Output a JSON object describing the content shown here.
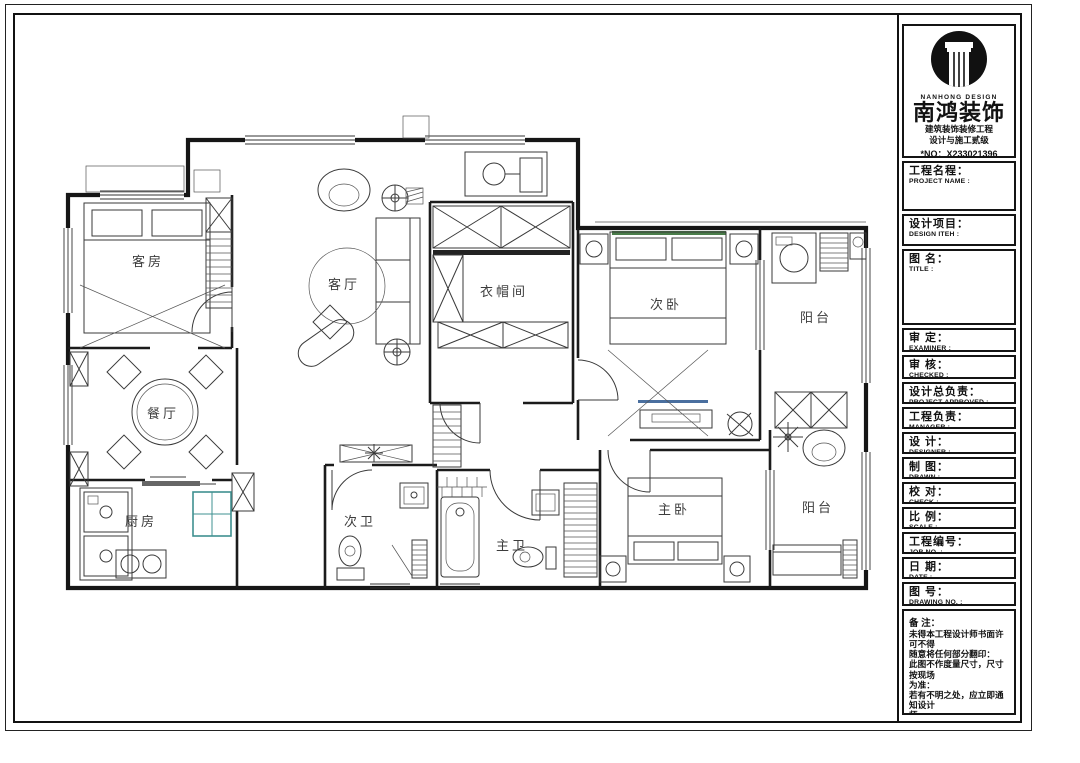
{
  "plan": {
    "rooms": [
      {
        "id": "guest-room",
        "label": "客房"
      },
      {
        "id": "living-room",
        "label": "客厅"
      },
      {
        "id": "cloakroom",
        "label": "衣帽间"
      },
      {
        "id": "second-bedroom",
        "label": "次卧"
      },
      {
        "id": "balcony-north",
        "label": "阳台"
      },
      {
        "id": "dining-room",
        "label": "餐厅"
      },
      {
        "id": "kitchen",
        "label": "厨房"
      },
      {
        "id": "second-bathroom",
        "label": "次卫"
      },
      {
        "id": "master-bathroom",
        "label": "主卫"
      },
      {
        "id": "master-bedroom",
        "label": "主卧"
      },
      {
        "id": "balcony-south",
        "label": "阳台"
      }
    ]
  },
  "titleblock": {
    "brand_en": "NANHONG DESIGN",
    "brand_cn": "南鸿装饰",
    "cert_line1": "建筑装饰装修工程",
    "cert_line2": "设计与施工贰级",
    "cert_no": "*NO：X233021396",
    "fields": [
      {
        "cn": "工程名程：",
        "en": "PROJECT NAME :"
      },
      {
        "cn": "设计项目：",
        "en": "DESIGN ITEH :"
      },
      {
        "cn": "图  名：",
        "en": "TITLE :"
      },
      {
        "cn": "审  定：",
        "en": "EXAMINER :"
      },
      {
        "cn": "审  核：",
        "en": "CHECKED :"
      },
      {
        "cn": "设计总负责：",
        "en": "PROJECT APPROVED :"
      },
      {
        "cn": "工程负责：",
        "en": "MANAGER :"
      },
      {
        "cn": "设  计：",
        "en": "DESIGNER :"
      },
      {
        "cn": "制  图：",
        "en": "DRAWN :"
      },
      {
        "cn": "校  对：",
        "en": "CHECK :"
      },
      {
        "cn": "比  例：",
        "en": "SCALE :"
      },
      {
        "cn": "工程编号：",
        "en": "JOB NO. :"
      },
      {
        "cn": "日  期：",
        "en": "DATE :"
      },
      {
        "cn": "图  号：",
        "en": "DRAWING NO. :"
      }
    ],
    "notes_title": "备 注：",
    "notes_lines": [
      "未得本工程设计师书面许可不得",
      "随意将任何部分翻印：",
      "此图不作度量尺寸，尺寸按现场",
      "为准：",
      "若有不明之处，应立即通知设计",
      "师。"
    ],
    "notes_fine": "本设计版权归南鸿设计机构所有",
    "hotline": "免费咨询电话:400 8383 168"
  }
}
